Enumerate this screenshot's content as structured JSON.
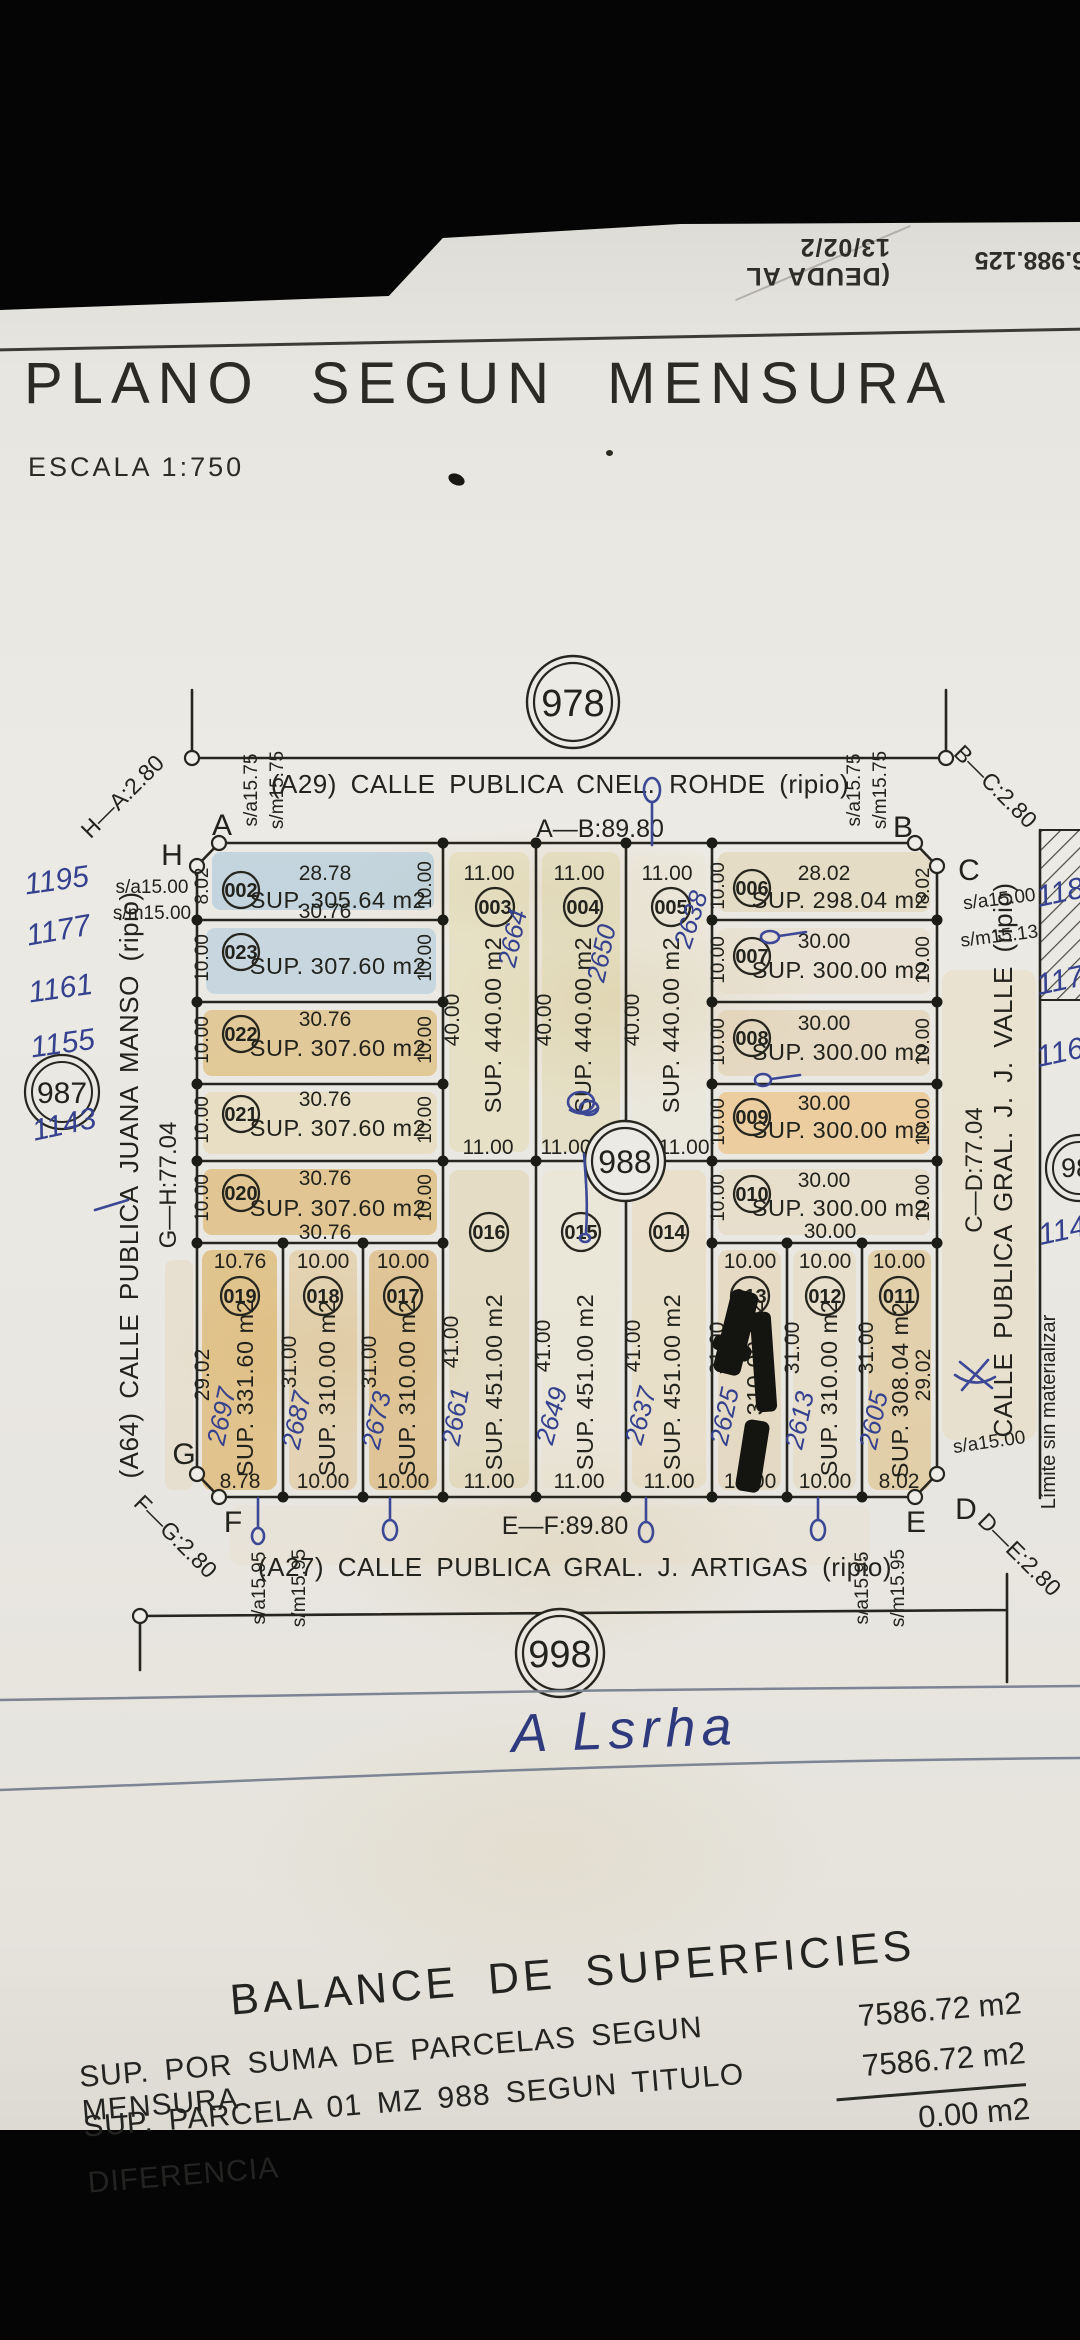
{
  "photo": {
    "debt_note": "(DEUDA AL 13/02/2",
    "file_number": "6.988.125"
  },
  "title": {
    "main": "PLANO SEGUN MENSURA",
    "scale": "ESCALA 1:750"
  },
  "blocks": {
    "north": "978",
    "center": "988",
    "south": "998",
    "west": "987",
    "east": "98"
  },
  "streets": {
    "north": {
      "name": "(A29) CALLE PUBLICA CNEL. ROHDE (ripio)",
      "dim": "A—B:89.80"
    },
    "south": {
      "name": "(A27) CALLE PUBLICA GRAL. J. ARTIGAS (ripio)",
      "dim": "E—F:89.80"
    },
    "west": {
      "name": "(A64) CALLE PUBLICA JUANA MANSO (ripio)",
      "dim": "G—H:77.04"
    },
    "east": {
      "name": "CALLE PUBLICA GRAL. J. J. VALLE (ripio)",
      "dim": "C—D:77.04"
    }
  },
  "corners": {
    "A": "A",
    "B": "B",
    "C": "C",
    "D": "D",
    "E": "E",
    "F": "F",
    "G": "G",
    "H": "H",
    "ha": "H—A:2.80",
    "bc": "B—C:2.80",
    "de": "D—E:2.80",
    "fg": "F—G:2.80"
  },
  "setbacks": {
    "n1": "s/a15.75",
    "n2": "s/m15.75",
    "w1": "s/a15.00",
    "w2": "s/m15.00",
    "e1": "s/a15.00",
    "e2": "s/m15.13",
    "s1": "s/a15.95",
    "s2": "s/m15.95",
    "se": "s/a15.00"
  },
  "west_margin": {
    "nums": [
      "1195",
      "1177",
      "1161",
      "1155",
      "1143"
    ]
  },
  "east_margin": {
    "limit": "Límite sin materializar",
    "nums": [
      "118",
      "117",
      "116",
      "114"
    ]
  },
  "parcels": {
    "p002": {
      "id": "002",
      "top": "28.78",
      "sup": "SUP. 305.64 m2",
      "bottom": "30.76",
      "left": "8.02",
      "right": "10.00"
    },
    "p023": {
      "id": "023",
      "sup": "SUP. 307.60 m2",
      "left": "10.00",
      "right": "10.00"
    },
    "p022": {
      "id": "022",
      "top": "30.76",
      "sup": "SUP. 307.60 m2",
      "left": "10.00",
      "right": "10.00"
    },
    "p021": {
      "id": "021",
      "top": "30.76",
      "sup": "SUP. 307.60 m2",
      "left": "10.00",
      "right": "10.00"
    },
    "p020": {
      "id": "020",
      "top": "30.76",
      "sup": "SUP. 307.60 m2",
      "bottom": "30.76",
      "left": "10.00",
      "right": "10.00"
    },
    "p003": {
      "id": "003",
      "top": "11.00",
      "depth": "40.00",
      "sup": "SUP. 440.00 m2",
      "bottom": "11.00",
      "hw": "2664"
    },
    "p004": {
      "id": "004",
      "top": "11.00",
      "depth": "40.00",
      "sup": "SUP. 440.00 m2",
      "bottom": "11.00",
      "hw": "2650"
    },
    "p005": {
      "id": "005",
      "top": "11.00",
      "depth": "40.00",
      "sup": "SUP. 440.00 m2",
      "bottom": "11.00",
      "hw": "2638"
    },
    "p006": {
      "id": "006",
      "top": "28.02",
      "sup": "SUP. 298.04 m2",
      "left": "10.00",
      "right": "8.02"
    },
    "p007": {
      "id": "007",
      "top": "30.00",
      "sup": "SUP. 300.00 m2",
      "left": "10.00",
      "right": "10.00"
    },
    "p008": {
      "id": "008",
      "top": "30.00",
      "sup": "SUP. 300.00 m2",
      "left": "10.00",
      "right": "10.00"
    },
    "p009": {
      "id": "009",
      "top": "30.00",
      "sup": "SUP. 300.00 m2",
      "left": "10.00",
      "right": "10.00"
    },
    "p010": {
      "id": "010",
      "top": "30.00",
      "sup": "SUP. 300.00 m2",
      "bottom": "30.00",
      "left": "10.00",
      "right": "10.00"
    },
    "p019": {
      "id": "019",
      "top": "10.76",
      "depth": "29.02",
      "sup": "SUP. 331.60 m2",
      "bottom": "8.78",
      "hw": "2697"
    },
    "p018": {
      "id": "018",
      "top": "10.00",
      "depth": "31.00",
      "sup": "SUP. 310.00 m2",
      "bottom": "10.00",
      "hw": "2687"
    },
    "p017": {
      "id": "017",
      "top": "10.00",
      "depth": "31.00",
      "sup": "SUP. 310.00 m2",
      "bottom": "10.00",
      "hw": "2673"
    },
    "p016": {
      "id": "016",
      "depth": "41.00",
      "sup": "SUP. 451.00 m2",
      "bottom": "11.00",
      "hw": "2661"
    },
    "p015": {
      "id": "015",
      "depth": "41.00",
      "sup": "SUP. 451.00 m2",
      "bottom": "11.00",
      "hw": "2649"
    },
    "p014": {
      "id": "014",
      "depth": "41.00",
      "sup": "SUP. 451.00 m2",
      "bottom": "11.00",
      "hw": "2637"
    },
    "p013": {
      "id": "013",
      "top": "10.00",
      "depth": "31.00",
      "sup": "SUP. 310.00 m2",
      "bottom": "10.00",
      "hw": "2625"
    },
    "p012": {
      "id": "012",
      "top": "10.00",
      "depth": "31.00",
      "sup": "SUP. 310.00 m2",
      "bottom": "10.00",
      "hw": "2613"
    },
    "p011": {
      "id": "011",
      "top": "10.00",
      "depth": "31.00",
      "right": "29.02",
      "sup": "SUP. 308.04 m2",
      "bottom": "8.02",
      "hw": "2605"
    }
  },
  "signature": "A Lsrha",
  "balance": {
    "title": "BALANCE DE SUPERFICIES",
    "rows": [
      {
        "label": "SUP. POR SUMA DE PARCELAS SEGUN MENSURA",
        "value": "7586.72 m2"
      },
      {
        "label": "SUP. PARCELA 01 MZ 988 SEGUN TITULO",
        "value": "7586.72 m2"
      },
      {
        "label": "DIFERENCIA",
        "value": "0.00 m2"
      }
    ]
  }
}
